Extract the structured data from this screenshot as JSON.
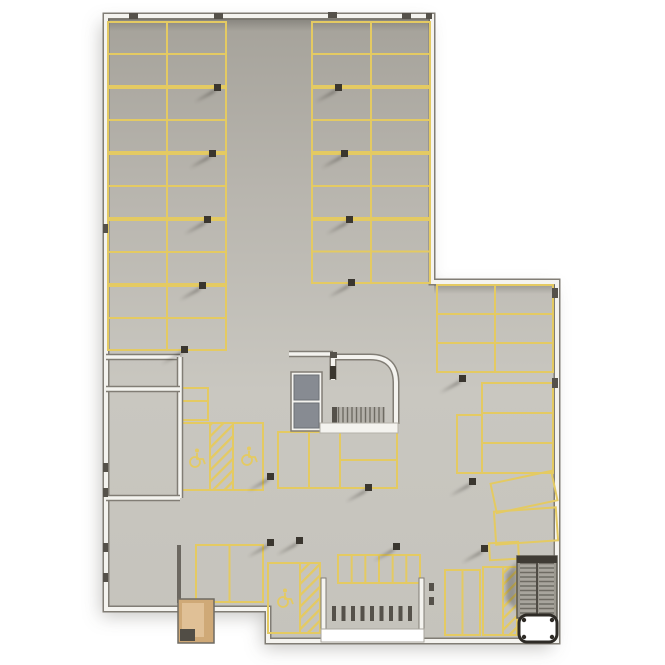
{
  "scene": {
    "width": 665,
    "height": 665,
    "label": "parking-garage-floor-plan-top-view"
  },
  "colors": {
    "page_bg": "#ffffff",
    "floor_dark": "#a5a29a",
    "floor_mid": "#b8b5ae",
    "floor_light": "#c9c7c0",
    "line_yellow": "#e4ca62",
    "wall_white": "#f4f3ef",
    "wall_edge": "#817d75",
    "column": "#3a362f",
    "column_shadow": "rgba(28,24,19,0.5)",
    "elevator": "#878b92",
    "elevator_edge": "#6c7077",
    "stair_bg": "#9b988f",
    "stair_tread": "#6e6b63",
    "room_tan": "#cfa977",
    "room_tan_light": "#e0c096",
    "structure_white": "#ffffff",
    "ink_dark": "#55514a",
    "dark_wall": "#6b6760"
  },
  "outline": {
    "points": [
      [
        106,
        16
      ],
      [
        432,
        16
      ],
      [
        432,
        282
      ],
      [
        557,
        282
      ],
      [
        557,
        641
      ],
      [
        268,
        641
      ],
      [
        268,
        609
      ],
      [
        106,
        609
      ]
    ]
  },
  "parking_grids": [
    {
      "x": 108,
      "y": 22,
      "w": 118,
      "h": 64,
      "cols": 2,
      "rows": 2
    },
    {
      "x": 108,
      "y": 88,
      "w": 118,
      "h": 64,
      "cols": 2,
      "rows": 2
    },
    {
      "x": 108,
      "y": 154,
      "w": 118,
      "h": 64,
      "cols": 2,
      "rows": 2
    },
    {
      "x": 108,
      "y": 220,
      "w": 118,
      "h": 64,
      "cols": 2,
      "rows": 2
    },
    {
      "x": 108,
      "y": 286,
      "w": 118,
      "h": 64,
      "cols": 2,
      "rows": 2
    },
    {
      "x": 312,
      "y": 22,
      "w": 118,
      "h": 64,
      "cols": 2,
      "rows": 2
    },
    {
      "x": 312,
      "y": 88,
      "w": 118,
      "h": 64,
      "cols": 2,
      "rows": 2
    },
    {
      "x": 312,
      "y": 154,
      "w": 118,
      "h": 64,
      "cols": 2,
      "rows": 2
    },
    {
      "x": 312,
      "y": 220,
      "w": 118,
      "h": 63,
      "cols": 2,
      "rows": 2
    },
    {
      "x": 437,
      "y": 285,
      "w": 116,
      "h": 87,
      "cols": 2,
      "rows": 3
    },
    {
      "x": 482,
      "y": 383,
      "w": 71,
      "h": 90,
      "cols": 1,
      "rows": 3
    },
    {
      "x": 457,
      "y": 415,
      "w": 25,
      "h": 58,
      "cols": 1,
      "rows": 1
    },
    {
      "x": 278,
      "y": 432,
      "w": 62,
      "h": 56,
      "cols": 2,
      "rows": 1
    },
    {
      "x": 340,
      "y": 432,
      "w": 57,
      "h": 56,
      "cols": 1,
      "rows": 2
    },
    {
      "x": 196,
      "y": 545,
      "w": 67,
      "h": 57,
      "cols": 2,
      "rows": 1
    },
    {
      "x": 445,
      "y": 570,
      "w": 35,
      "h": 65,
      "cols": 2,
      "rows": 1
    },
    {
      "x": 338,
      "y": 555,
      "w": 82,
      "h": 28,
      "cols": 6,
      "rows": 1
    },
    {
      "x": 181,
      "y": 388,
      "w": 27,
      "h": 13,
      "cols": 1,
      "rows": 1
    },
    {
      "x": 181,
      "y": 401,
      "w": 27,
      "h": 19,
      "cols": 1,
      "rows": 1
    },
    {
      "x": 483,
      "y": 567,
      "w": 20,
      "h": 68,
      "cols": 1,
      "rows": 1
    }
  ],
  "hatch_areas": [
    {
      "x": 503,
      "y": 567,
      "w": 14,
      "h": 68
    }
  ],
  "accessible_bays": [
    {
      "x": 180,
      "y": 423,
      "w": 83,
      "h": 67,
      "dividers_x": [
        210,
        233
      ],
      "hatch": {
        "x": 210,
        "y": 423,
        "w": 23,
        "h": 67
      },
      "symbols": [
        [
          195,
          458
        ],
        [
          247,
          456
        ]
      ]
    },
    {
      "x": 268,
      "y": 563,
      "w": 52,
      "h": 70,
      "dividers_x": [
        300
      ],
      "hatch": {
        "x": 300,
        "y": 563,
        "w": 20,
        "h": 70
      },
      "symbols": [
        [
          283,
          598
        ]
      ]
    }
  ],
  "angled_spaces": [
    {
      "cx": 524,
      "cy": 492,
      "w": 62,
      "h": 30,
      "rot": -12
    },
    {
      "cx": 526,
      "cy": 526,
      "w": 62,
      "h": 33,
      "rot": -4
    },
    {
      "cx": 504,
      "cy": 551,
      "w": 29,
      "h": 17,
      "rot": -3
    }
  ],
  "columns": [
    [
      215,
      87
    ],
    [
      210,
      153
    ],
    [
      205,
      219
    ],
    [
      200,
      285
    ],
    [
      182,
      349
    ],
    [
      336,
      87
    ],
    [
      342,
      153
    ],
    [
      347,
      219
    ],
    [
      349,
      282
    ],
    [
      460,
      378
    ],
    [
      366,
      487
    ],
    [
      470,
      481
    ],
    [
      482,
      548
    ],
    [
      268,
      476
    ],
    [
      268,
      542
    ],
    [
      297,
      540
    ],
    [
      394,
      546
    ]
  ],
  "inner_walls": [
    {
      "x1": 106,
      "y1": 357,
      "x2": 180,
      "y2": 357
    },
    {
      "x1": 180,
      "y1": 357,
      "x2": 180,
      "y2": 498
    },
    {
      "x1": 106,
      "y1": 498,
      "x2": 180,
      "y2": 498
    },
    {
      "x1": 106,
      "y1": 389,
      "x2": 180,
      "y2": 389
    },
    {
      "x1": 289,
      "y1": 354,
      "x2": 333,
      "y2": 354
    }
  ],
  "wall_ticks": [
    [
      129,
      13,
      9,
      6
    ],
    [
      214,
      13,
      9,
      6
    ],
    [
      328,
      12,
      9,
      6
    ],
    [
      402,
      13,
      9,
      6
    ],
    [
      426,
      13,
      6,
      6
    ],
    [
      103,
      224,
      5,
      9
    ],
    [
      103,
      463,
      5,
      9
    ],
    [
      103,
      488,
      5,
      9
    ],
    [
      103,
      543,
      5,
      9
    ],
    [
      103,
      573,
      5,
      9
    ],
    [
      552,
      288,
      6,
      10
    ],
    [
      552,
      378,
      6,
      10
    ],
    [
      429,
      583,
      5,
      8
    ],
    [
      429,
      597,
      5,
      8
    ],
    [
      330,
      352,
      7,
      6
    ]
  ],
  "dark_wall": {
    "x": 177,
    "y": 545,
    "w": 4,
    "h": 58
  },
  "core": {
    "room_path": "M 333,380 L 333,357 L 370,357 Q 396,357 396,383 L 396,424",
    "elevator": {
      "x": 291,
      "y": 372,
      "w": 31,
      "h": 59,
      "cells": [
        [
          294,
          375,
          25,
          25
        ],
        [
          294,
          403,
          25,
          25
        ]
      ]
    },
    "stairs": {
      "x": 337,
      "y": 407,
      "w": 48,
      "h": 17
    },
    "stairs_dark": {
      "x": 332,
      "y": 407,
      "w": 6,
      "h": 17
    },
    "front_band": {
      "x": 320,
      "y": 423,
      "w": 78,
      "h": 10
    },
    "door": {
      "x": 330,
      "y": 366,
      "w": 6,
      "h": 13
    }
  },
  "bike_area": {
    "posts": [
      [
        321,
        578,
        5,
        57
      ],
      [
        419,
        578,
        5,
        57
      ]
    ],
    "band": {
      "x": 321,
      "y": 629,
      "w": 103,
      "h": 13
    },
    "racks": {
      "x0": 332,
      "y": 606,
      "count": 9,
      "step": 9.5,
      "w": 4,
      "h": 15
    }
  },
  "utility_room": {
    "x": 178,
    "y": 599,
    "w": 36,
    "h": 44,
    "inner": {
      "x": 182,
      "y": 603,
      "w": 22,
      "h": 34
    },
    "dark": {
      "x": 180,
      "y": 629,
      "w": 15,
      "h": 12
    }
  },
  "stair_block": {
    "x": 517,
    "y": 556,
    "w": 40,
    "h": 62,
    "flights": [
      [
        520,
        559,
        16,
        56
      ],
      [
        539,
        559,
        15,
        56
      ]
    ],
    "divider": {
      "x1": 537,
      "y1": 559,
      "x2": 537,
      "y2": 615
    },
    "cap": {
      "x": 517,
      "y": 556,
      "w": 40,
      "h": 7
    }
  },
  "white_structure": {
    "x": 519,
    "y": 615,
    "w": 38,
    "h": 27,
    "r": 8
  }
}
